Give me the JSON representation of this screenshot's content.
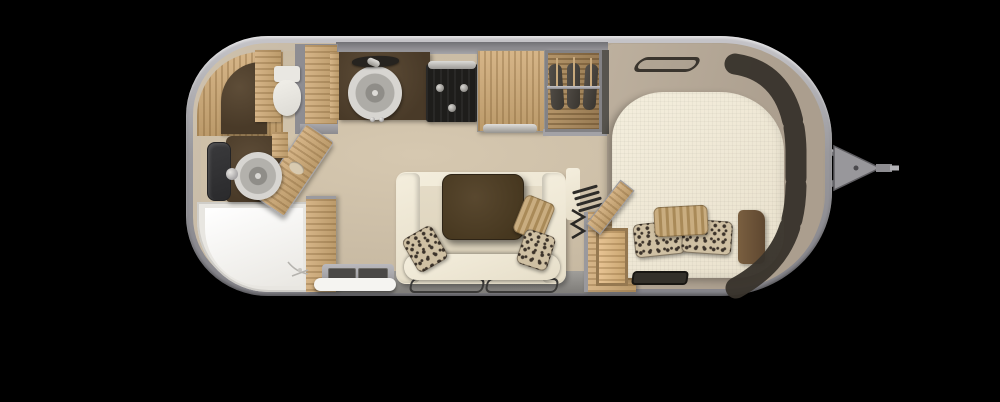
{
  "labels": {
    "floorplan": "Travel trailer floor plan (top view)",
    "shell": "Trailer shell",
    "hitch": "Tow hitch and A-frame",
    "front_windows": "Panoramic front window band",
    "overhead_bin": "Overhead locker outline",
    "bath_cabinet": "Rear bathroom cabinetry",
    "bath_counter": "Bathroom counter",
    "toilet": "Toilet",
    "bath_wall": "Partition wall",
    "pantry": "Pantry cabinet",
    "bath_door": "Bathroom door (open)",
    "vanity": "Vanity counter",
    "bath_sink": "Bathroom sink",
    "bath_faucet": "Bathroom faucet",
    "mirror": "Bathroom mirror",
    "shower": "Shower pan",
    "shower_wall": "Shower partition wall",
    "entry_step": "Entry step",
    "kitchen_counter": "Kitchen counter",
    "range_hood": "Range hood",
    "kitchen_sink": "Kitchen sink",
    "kitchen_faucet": "Kitchen faucet",
    "cooktop": "Cooktop / oven",
    "oven_handle": "Oven handle",
    "fridge": "Refrigerator",
    "fridge_handle": "Refrigerator handle",
    "wardrobe": "Wardrobe with hanging clothes",
    "hanger_rod": "Wardrobe hanger rod",
    "garment": "Hanging garment",
    "sofa": "Sofa",
    "sofa_arm": "Sofa armrest",
    "sofa_seat": "Sofa seat bolster",
    "table": "Dinette table",
    "pillow_leopard": "Patterned accent pillow",
    "pillow_stripe": "Striped accent pillow",
    "chair_outline": "Folding table outline",
    "storage_box": "Storage compartment",
    "storage_lid": "Storage lid (open)",
    "vent_louvers": "Vent louvers",
    "furnace_coil": "Furnace symbol",
    "bed": "Bed mattress",
    "bed_tray": "Storage tray",
    "nightstand": "Corner cabinet",
    "bedroom_floor": "Bedroom area",
    "drain": "Shower drain"
  },
  "colors": {
    "bg": "#000000",
    "shell_outer": "#c6c5c9",
    "shell_tan": "#b2a695",
    "shell_tan_light": "#cfc2ad",
    "floor_beige": "#d6c8b0",
    "bedroom_tan": "#ab9e8e",
    "wood": "#d6b588",
    "wood_dark": "#bb9a6a",
    "counter_dark": "#493a28",
    "stove_black": "#1e1d1b",
    "cream": "#f4eedd",
    "table_brown": "#46371f",
    "window_dark": "#3a352e",
    "pillow_base": "#cfc0a3",
    "pillow_dot": "#3c332a",
    "pillow_tan": "#c9ad80",
    "tray_dark": "#33302a",
    "nightstand": "#5e4730",
    "metal": "#9a999d"
  }
}
